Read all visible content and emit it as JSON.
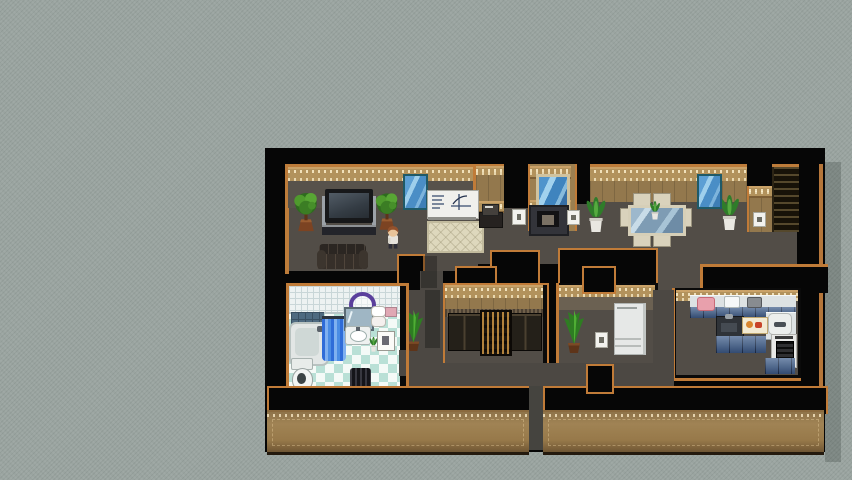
{
  "meta": {
    "view_label": "Top-down RPG interior house map",
    "engine_style": "2D tile-based role-playing game interior",
    "background_texture": "plain noisy gray, map centered right"
  },
  "palette": {
    "background": "#9aa4a0",
    "void_black": "#060606",
    "wall_trim": "#b2925c",
    "wall_face_tan": "#93784d",
    "wall_face_dark": "#57524b",
    "wall_border_orange": "#c07b38",
    "floor_gray": "#524d47",
    "corridor_gray": "#4c4843",
    "bath_tile_light": "#f4faf7",
    "bath_tile_teal": "#b9e0d6",
    "shower_tile": "#4e6a80",
    "curtain_blue": "#3b7ce0",
    "window_glass": "#5c9fd4",
    "kitchen_cabinet_blue": "#41608c",
    "counter_white": "#dde2e3",
    "rug_cream": "#ded8bd",
    "plant_green": "#4f9a2d",
    "pot_terracotta": "#7c4322",
    "wood_dark": "#242019",
    "outer_band_tan": "#a08354"
  },
  "rooms": [
    {
      "id": "living-room",
      "label": "Living room",
      "items": [
        "potted tree",
        "television stand",
        "potted tree",
        "window",
        "whiteboard",
        "area rug",
        "sofa",
        "player character",
        "phone table"
      ]
    },
    {
      "id": "dining-room",
      "label": "Dining room",
      "items": [
        "potted plant",
        "dining table with four chairs",
        "potted plant",
        "window",
        "bookshelf",
        "wall outlet"
      ]
    },
    {
      "id": "hallway",
      "label": "Hallway",
      "items": [
        "floor plant"
      ]
    },
    {
      "id": "bathroom",
      "label": "Bathroom",
      "items": [
        "bathtub",
        "shower curtain",
        "shower tiles",
        "towel ring",
        "mirror",
        "sink",
        "toilet",
        "laundry basket",
        "wall frame",
        "shelf items"
      ]
    },
    {
      "id": "storage-room",
      "label": "Storage room",
      "items": [
        "wardrobe",
        "display shelf",
        "wardrobe"
      ]
    },
    {
      "id": "utility-room",
      "label": "Utility room",
      "items": [
        "floor plant",
        "light switch",
        "refrigerator"
      ]
    },
    {
      "id": "kitchen",
      "label": "Kitchen",
      "items": [
        "counter with food",
        "kitchen sink",
        "cutting board",
        "rice cooker",
        "stove",
        "blue cabinets"
      ]
    }
  ],
  "character": {
    "label": "Player character",
    "hair_color": "#93512c",
    "shirt_color": "#e6e3dc",
    "position": "living room, below right plant"
  },
  "fixtures": {
    "fireplace_label": "Fireplace stove",
    "whiteboard_label": "Whiteboard with notes and chart",
    "bookshelf_label": "Tall bookshelf"
  }
}
